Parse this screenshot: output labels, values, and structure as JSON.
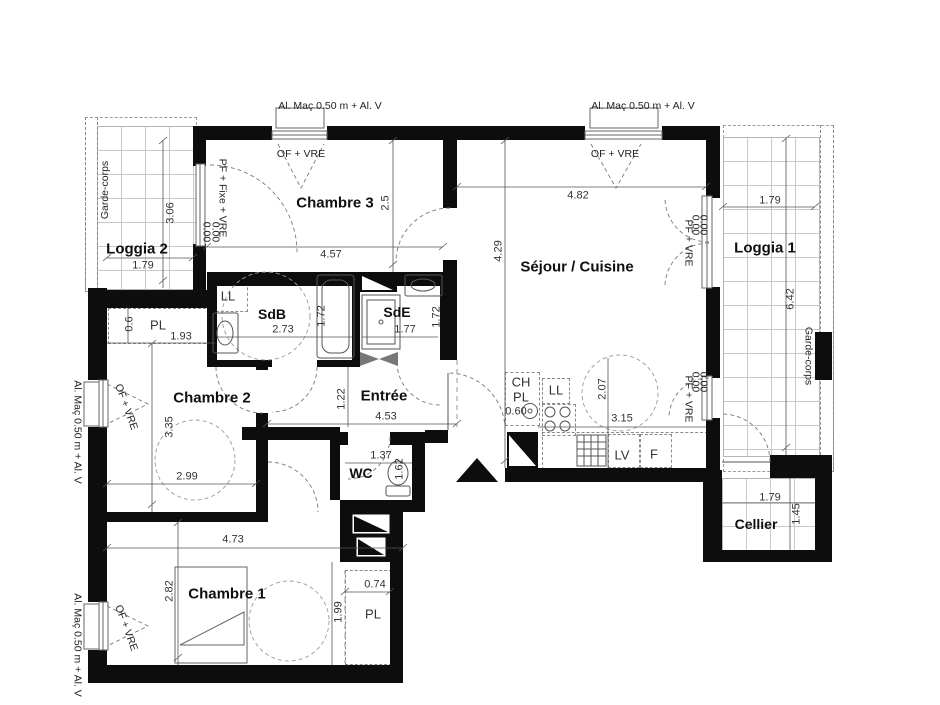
{
  "annotations": {
    "al_mac": "Al. Maç 0.50 m + Al. V",
    "of_vre": "OF + VRE",
    "pf_fixe_vre": "PF + Fixe + VRE",
    "pf_vre": "PF + VRE",
    "zero": "0.00",
    "garde_corps": "Garde-corps"
  },
  "rooms": {
    "loggia2": {
      "name": "Loggia 2",
      "width": "1.79",
      "depth": "3.06"
    },
    "chambre3": {
      "name": "Chambre 3",
      "width": "4.57",
      "depth": "2.5"
    },
    "sejour": {
      "name": "Séjour / Cuisine",
      "width": "4.82",
      "depth": "4.29"
    },
    "loggia1": {
      "name": "Loggia 1",
      "width": "1.79",
      "depth": "6.42"
    },
    "sdb": {
      "name": "SdB",
      "width": "2.73",
      "depth": "1.72",
      "washer": "LL"
    },
    "sde": {
      "name": "SdE",
      "width": "1.77",
      "depth": "1.72"
    },
    "chambre2": {
      "name": "Chambre 2",
      "width": "2.99",
      "depth": "3.35"
    },
    "entree": {
      "name": "Entrée",
      "width": "4.53",
      "depth": "1.22"
    },
    "wc": {
      "name": "WC",
      "width": "1.37",
      "depth": "1.62"
    },
    "chambre1": {
      "name": "Chambre 1",
      "width": "4.73",
      "depth": "2.82",
      "depth_right": "1.99"
    },
    "cellier": {
      "name": "Cellier",
      "width": "1.79",
      "depth": "1.45"
    }
  },
  "closets": {
    "chambre2_pl": {
      "label": "PL",
      "depth": "0.6",
      "width": "1.93"
    },
    "entree_ch": {
      "line1": "CH",
      "line2": "PL",
      "width": "0.60"
    },
    "chambre1_pl": {
      "label": "PL",
      "width": "0.74"
    }
  },
  "kitchen": {
    "width": "3.15",
    "depth": "2.07",
    "washer": "LL",
    "dishwasher": "LV",
    "fridge": "F"
  }
}
